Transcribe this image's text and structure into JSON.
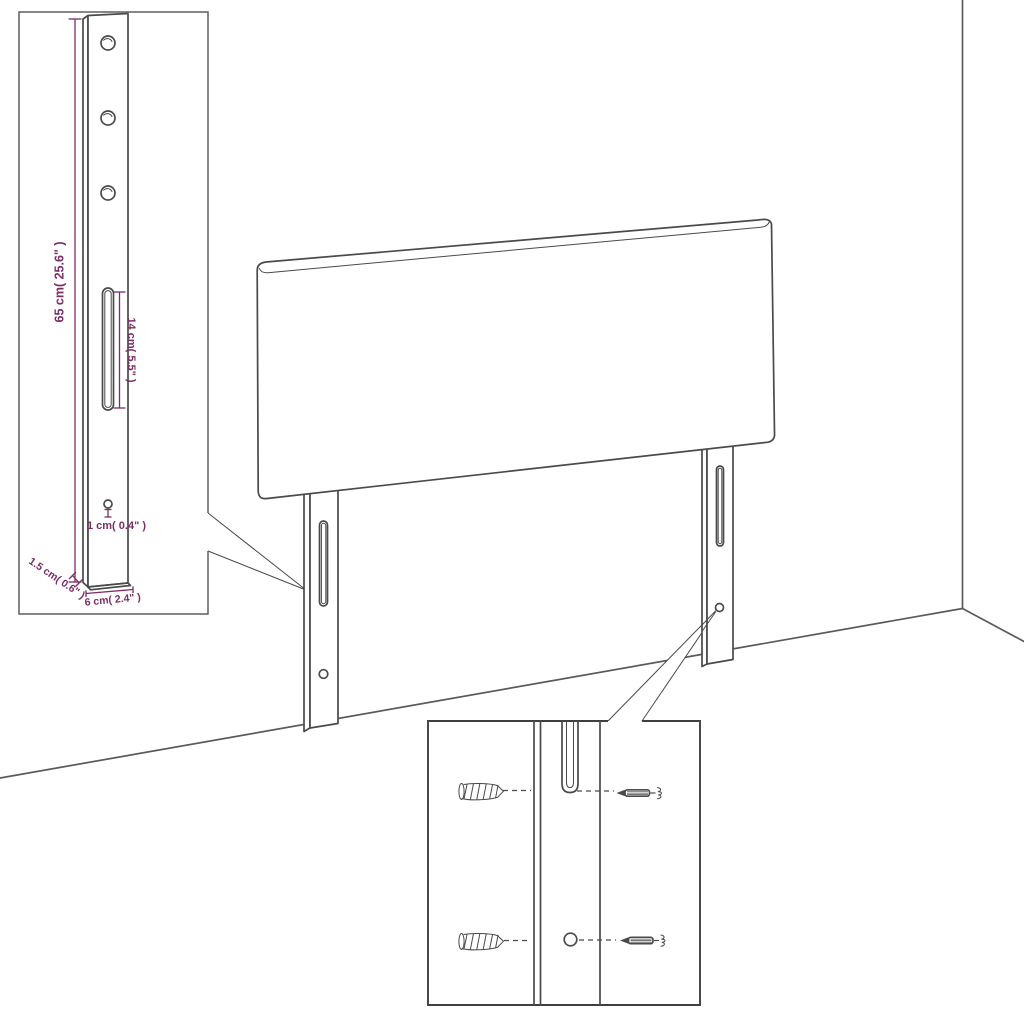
{
  "diagram": {
    "title": "headboard-assembly-dimension-diagram",
    "palette": {
      "line_color": "#4a4a4a",
      "dimension_color": "#7b2d66",
      "background": "#ffffff"
    },
    "inset_bracket": {
      "labels": {
        "bracket_height": "65 cm( 25.6\" )",
        "slot_length": "14 cm( 5.5\" )",
        "hole_diameter": "1 cm( 0.4\" )",
        "bracket_thickness": "1.5 cm( 0.6\" )",
        "bracket_width": "6 cm( 2.4\" )"
      }
    },
    "inset_mounting": {
      "parts": [
        "wall-plug",
        "screw",
        "leg-slot",
        "leg-hole"
      ]
    }
  }
}
